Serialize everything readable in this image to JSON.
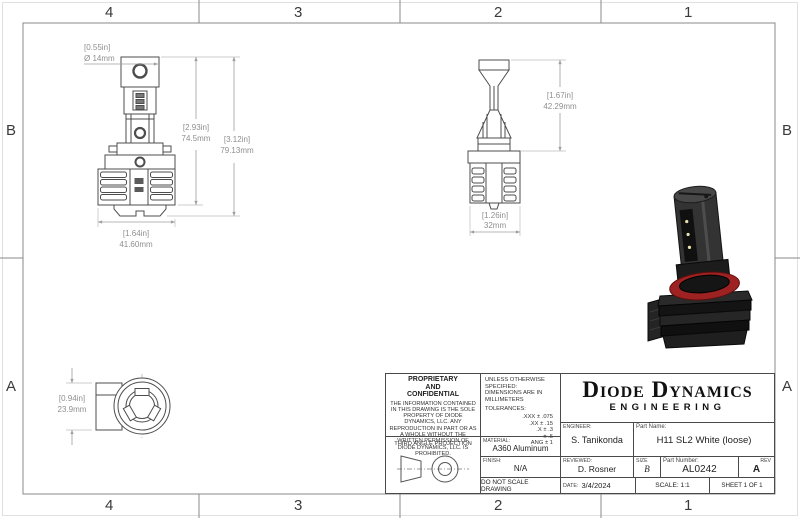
{
  "sheet": {
    "zone_columns": [
      "4",
      "3",
      "2",
      "1"
    ],
    "zone_rows": [
      "B",
      "A"
    ]
  },
  "drawing": {
    "line_color": "#4d4d4d",
    "dim_color": "#9f9f9f",
    "accent_red": "#9e2222",
    "dimensions": {
      "front_diameter_in": "[0.55in]",
      "front_diameter_mm": "Ø 14mm",
      "front_height_inner_in": "[2.93in]",
      "front_height_inner_mm": "74.5mm",
      "front_height_outer_in": "[3.12in]",
      "front_height_outer_mm": "79.13mm",
      "front_width_in": "[1.64in]",
      "front_width_mm": "41.60mm",
      "side_height_in": "[1.67in]",
      "side_height_mm": "42.29mm",
      "side_width_in": "[1.26in]",
      "side_width_mm": "32mm",
      "top_height_in": "[0.94in]",
      "top_height_mm": "23.9mm"
    }
  },
  "title_block": {
    "proprietary_heading_1": "PROPRIETARY",
    "proprietary_heading_2": "AND",
    "proprietary_heading_3": "CONFIDENTIAL",
    "proprietary_body": "THE INFORMATION CONTAINED IN THIS DRAWING IS THE SOLE PROPERTY OF DIODE DYNAMICS, LLC.  ANY REPRODUCTION IN PART OR AS A WHOLE WITHOUT THE WRITTEN PERMISSION OF DIODE DYNAMICS, LLC. IS PROHIBITED.",
    "third_angle_label": "THIRD ANGLE PROJECTION",
    "unless_line1": "UNLESS OTHERWISE SPECIFIED:",
    "unless_line2": "DIMENSIONS ARE IN MILLIMETERS",
    "tolerances_label": "TOLERANCES:",
    "tolerances": [
      ".XXX ± .075",
      ".XX ± .15",
      ".X ± .3",
      "± .5",
      "ANG ± 1"
    ],
    "material_label": "MATERIAL:",
    "material_value": "A360 Aluminum",
    "finish_label": "FINISH:",
    "finish_value": "N/A",
    "do_not_scale": "DO NOT SCALE DRAWING",
    "logo_line1": "Diode Dynamics",
    "logo_line2": "ENGINEERING",
    "engineer_label": "ENGINEER:",
    "engineer_value": "S. Tanikonda",
    "reviewed_label": "REVIEWED:",
    "reviewed_value": "D. Rosner",
    "date_label": "DATE:",
    "date_value": "3/4/2024",
    "part_name_label": "Part Name:",
    "part_name_value": "H11 SL2 White (loose)",
    "size_label": "SIZE",
    "size_value": "B",
    "part_number_label": "Part Number:",
    "part_number_value": "AL0242",
    "rev_label": "REV",
    "rev_value": "A",
    "scale_value": "SCALE: 1:1",
    "sheet_value": "SHEET 1 OF 1"
  }
}
